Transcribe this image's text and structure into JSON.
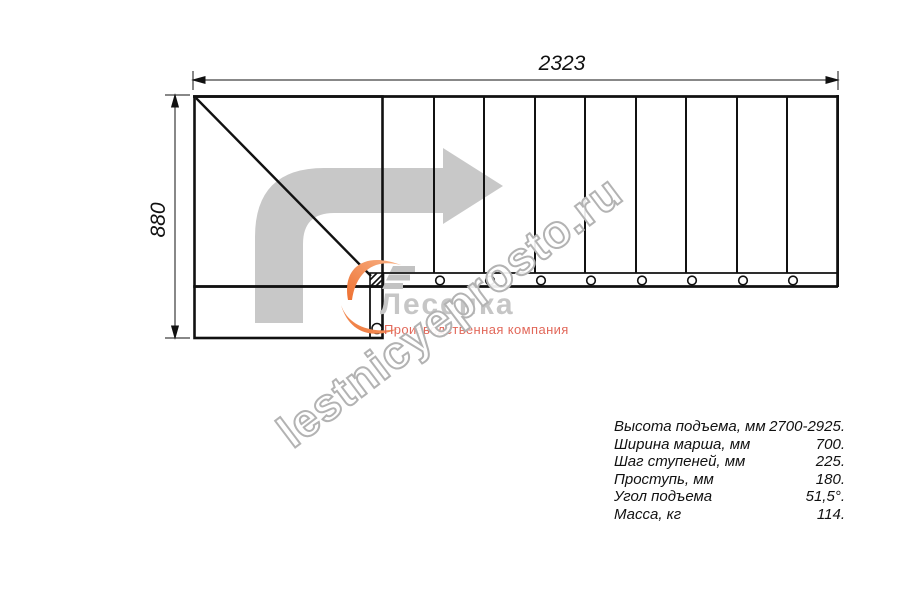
{
  "dimensions": {
    "width_mm": "2323",
    "height_mm": "880"
  },
  "watermark": {
    "text": "lestnicyeprosto.ru"
  },
  "logo": {
    "name": "Лесенка",
    "subtitle": "Производственная компания"
  },
  "specs": {
    "rows": [
      {
        "label": "Высота подъема, мм",
        "value": "2700-2925."
      },
      {
        "label": "Ширина марша, мм",
        "value": "700."
      },
      {
        "label": "Шаг ступеней, мм",
        "value": "225."
      },
      {
        "label": "Проступь, мм",
        "value": "180."
      },
      {
        "label": "Угол подъема",
        "value": "51,5°."
      },
      {
        "label": "Масса, кг",
        "value": "114."
      }
    ]
  },
  "colors": {
    "line_black": "#111111",
    "arrow_gray": "#c8c8c8",
    "logo_gray": "#c6c6c6",
    "stairs_gray": "#c2c2c2",
    "subtitle_red": "#e2685a",
    "swoosh_orange_dark": "#ee7132",
    "swoosh_orange_light": "#f8b286",
    "watermark_stroke": "#b3b3b3"
  }
}
